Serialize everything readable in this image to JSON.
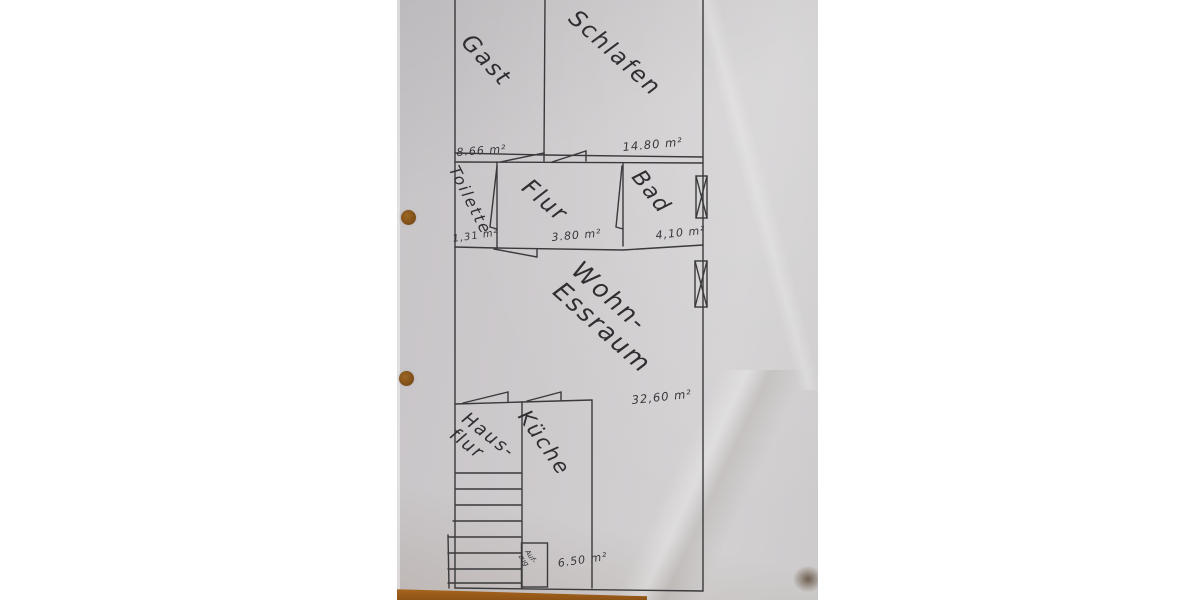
{
  "colors": {
    "background": "#ffffff",
    "paper": "#cdcacc",
    "ink": "#3a393b",
    "table_wood": "#a5601c",
    "punch_hole": "#8a5a20"
  },
  "floor_plan": {
    "rooms": {
      "gast": {
        "label": "Gast",
        "area": "8.66 m²"
      },
      "schlafen": {
        "label": "Schlafen",
        "area": "14.80 m²"
      },
      "toilette": {
        "label": "Toilette",
        "area": "1,31 m²"
      },
      "flur": {
        "label": "Flur",
        "area": "3.80 m²"
      },
      "bad": {
        "label": "Bad",
        "area": "4,10 m²"
      },
      "wohn_essraum": {
        "label": "Wohn-\nEssraum",
        "area": "32,60 m²"
      },
      "hausflur": {
        "label": "Haus-\nflur"
      },
      "kueche": {
        "label": "Küche",
        "area": "6.50 m²"
      },
      "aufzug": {
        "label": "Auf-\nzug"
      }
    }
  }
}
